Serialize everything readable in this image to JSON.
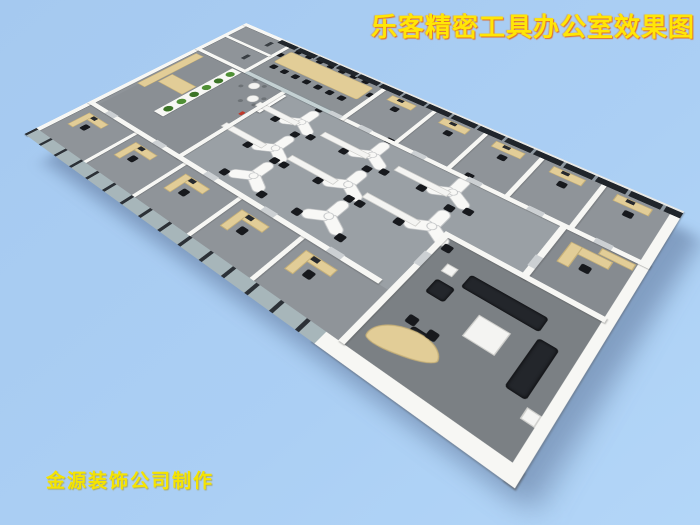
{
  "title": {
    "text": "乐客精密工具办公室效果图",
    "color": "#ffe606",
    "outline_color": "#ff7d00"
  },
  "credit": {
    "text": "金源装饰公司制作",
    "color": "#f5e400"
  },
  "background_color": "#a9cdf2",
  "palette": {
    "wall": "#f7f7f4",
    "floor": "#8f9499",
    "floor_open_area": "#9aa0a5",
    "floor_lounge": "#7b8084",
    "window_glass_dark": "#20252b",
    "curtain_wall_frame": "#2c3137",
    "partition_glass": "#b7c7cb",
    "wood_furniture": "#e2cd97",
    "office_chair": "#17191d",
    "sofa": "#23262b",
    "coffee_table": "#f4f4f2",
    "plant_green": "#4f8f35",
    "accent_red": "#c0392b",
    "building_shadow": "rgba(54,74,110,0.38)"
  }
}
